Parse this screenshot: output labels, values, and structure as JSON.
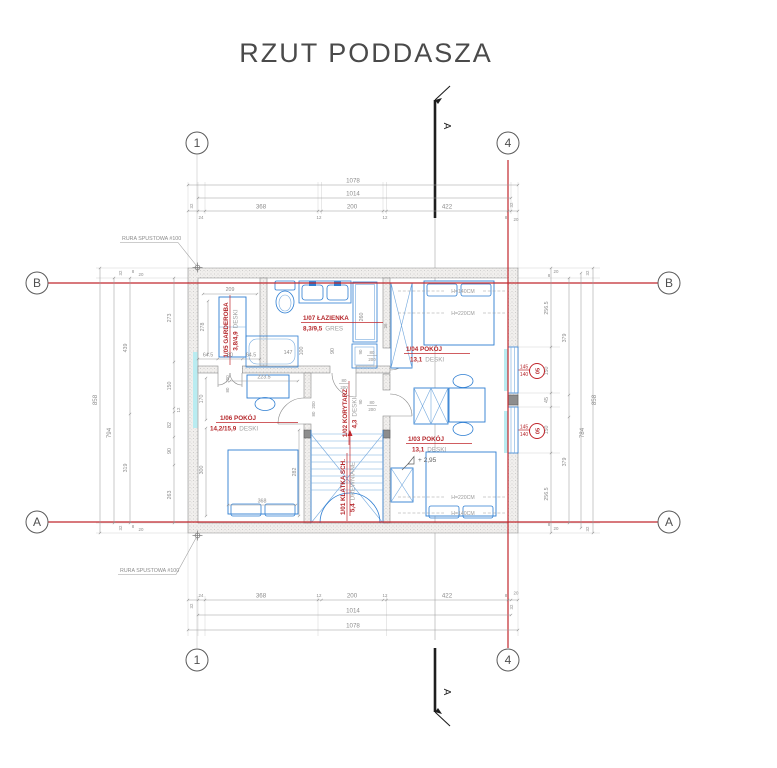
{
  "title": "RZUT PODDASZA",
  "section": {
    "label": "A"
  },
  "grid": {
    "c1": "1",
    "c4": "4",
    "rA": "A",
    "rB": "B"
  },
  "leaders": {
    "downpipe": "RURA SPUSTOWA #100"
  },
  "level": {
    "value": "+ 2,95"
  },
  "window_marker": {
    "code": "05",
    "width": "145",
    "sill": "140"
  },
  "heights": {
    "h140": "H=140CM",
    "h220": "H=220CM"
  },
  "door": {
    "w": "80",
    "h": "200"
  },
  "rooms": {
    "bath": {
      "label": "1/07 ŁAZIENKA",
      "area": "8,3/9,5",
      "floor": "GRES"
    },
    "ward": {
      "label": "1/05 GARDEROBA",
      "area": "3,8/4,9",
      "floor": "DESKI"
    },
    "corr": {
      "label": "1/02 KORYTARZ",
      "area": "4,3",
      "floor": "DESKI"
    },
    "stair": {
      "label": "1/01 KLATKA SCH.",
      "area": "5,4",
      "floor": "DREWNIANE"
    },
    "room06": {
      "label": "1/06 POKÓJ",
      "area": "14,2/15,9",
      "floor": "DESKI"
    },
    "room04": {
      "label": "1/04 POKÓJ",
      "area": "13,1",
      "floor": "DESKI"
    },
    "room03": {
      "label": "1/03 POKÓJ",
      "area": "13,1",
      "floor": "DESKI"
    }
  },
  "dims": {
    "top": {
      "total": "1078",
      "inner": "1014",
      "m32": "32",
      "s24": "24",
      "s368": "368",
      "s12": "12",
      "s200": "200",
      "s422": "422",
      "s8": "8",
      "s20": "20"
    },
    "left": {
      "total": "858",
      "inner": "794",
      "a439": "439",
      "a319": "319",
      "b273": "273",
      "b150": "150",
      "b12": "12",
      "b82": "82",
      "b90": "90",
      "b263": "263",
      "m32": "32",
      "m20": "20",
      "m8": "8"
    },
    "right": {
      "total": "858",
      "inner": "784",
      "a379": "379",
      "w2565": "256.5",
      "w150": "150",
      "w45": "45",
      "m32": "32",
      "m20": "20",
      "m8": "8"
    }
  },
  "interior": {
    "d209": "209",
    "d278": "278",
    "d645": "64.5",
    "d2235": "223.5",
    "d147": "147",
    "d100": "100",
    "d90": "90",
    "d260": "260",
    "d26": "26",
    "d170": "170",
    "d300": "300",
    "d368": "368",
    "d282": "282"
  }
}
